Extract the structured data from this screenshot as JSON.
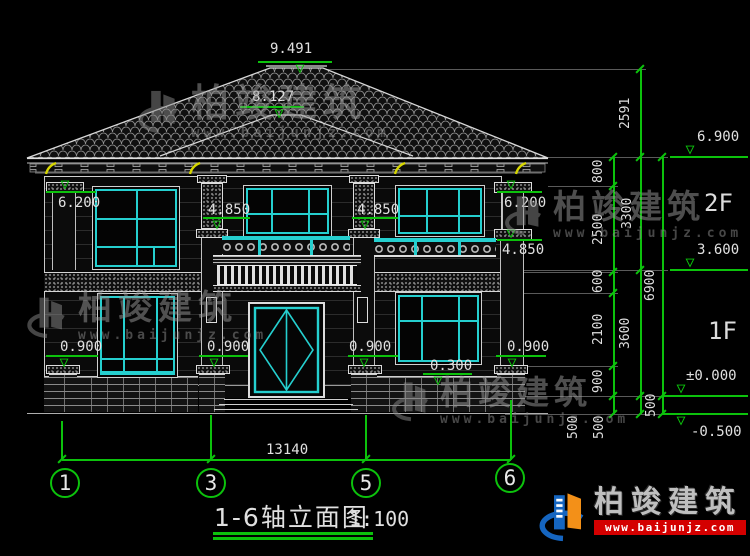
{
  "drawing": {
    "title": "1-6轴立面图",
    "scale": "1:100",
    "floor_labels": [
      "2F",
      "1F"
    ],
    "axis_bubbles": [
      "1",
      "3",
      "5",
      "6"
    ],
    "overall_width": "13140"
  },
  "levels": [
    {
      "label": "9.491"
    },
    {
      "label": "8.127"
    },
    {
      "label": "6.200"
    },
    {
      "label": "6.200"
    },
    {
      "label": "4.850"
    },
    {
      "label": "4.850"
    },
    {
      "label": "4.850"
    },
    {
      "label": "0.900"
    },
    {
      "label": "0.900"
    },
    {
      "label": "0.900"
    },
    {
      "label": "0.900"
    },
    {
      "label": "0.300"
    },
    {
      "label": "6.900"
    },
    {
      "label": "3.600"
    },
    {
      "label": "±0.000"
    },
    {
      "label": "-0.500"
    }
  ],
  "right_dimensions": [
    {
      "label": "800"
    },
    {
      "label": "2500"
    },
    {
      "label": "600"
    },
    {
      "label": "2100"
    },
    {
      "label": "900"
    },
    {
      "label": "500"
    },
    {
      "label": "500"
    },
    {
      "label": "2591"
    },
    {
      "label": "3300"
    },
    {
      "label": "3600"
    },
    {
      "label": "500"
    },
    {
      "label": "6900"
    }
  ],
  "watermark": {
    "brand": "柏竣建筑",
    "url": "www.baijunjz.com"
  },
  "footer_logo": {
    "brand": "柏竣建筑",
    "url": "www.baijunjz.com"
  },
  "icons": {
    "level_symbol": "▽"
  },
  "colors": {
    "dimension_green": "#0cc20c",
    "window_cyan": "#25cfcf",
    "bracket_yellow": "#d6d600",
    "logo_blue": "#1565c0",
    "logo_orange": "#f39018",
    "banner_red": "#d40000"
  }
}
